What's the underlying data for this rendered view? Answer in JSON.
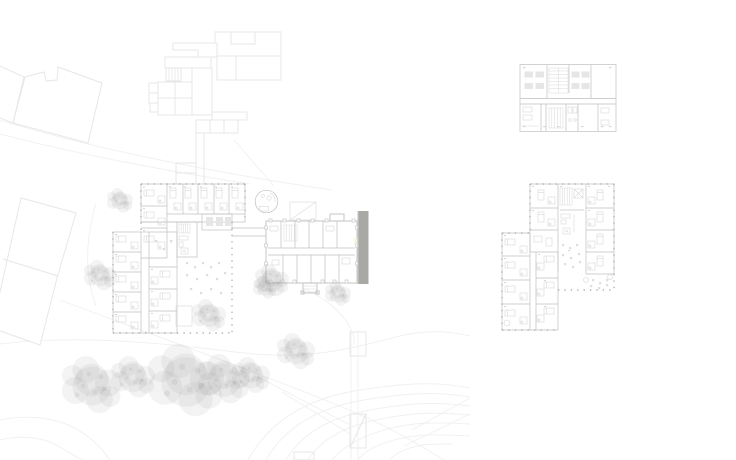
{
  "page": {
    "kind": "architectural-plan-sheet",
    "background": "#ffffff"
  },
  "colors": {
    "context_line": "#e7e7e7",
    "contour_line": "#f0f0f0",
    "wall_line": "#c0c0c0",
    "existing_wall_line": "#cfcfcf",
    "facade_column": "#b0b0b0",
    "furniture_line": "#d8d8d8",
    "accent_bar": "#a8a8a5",
    "tree_fill": "#c9c9c9",
    "highlight": "#f3efcf"
  },
  "plans": [
    {
      "id": "ground-floor-site-plan",
      "position": "left",
      "features": [
        "north-context-buildings",
        "neighbor-buildings",
        "patient-room-wings",
        "courtyard",
        "round-pavilion",
        "historic-building",
        "accent-bar",
        "trees",
        "contours"
      ]
    },
    {
      "id": "small-floor-plan",
      "position": "top-right",
      "features": [
        "day-rooms",
        "shelf-stair-core",
        "service-rooms"
      ]
    },
    {
      "id": "upper-floor-plan",
      "position": "middle-right",
      "features": [
        "north-wing-rooms",
        "west-wing-rooms",
        "stair-core",
        "dining-area",
        "terrace"
      ]
    }
  ]
}
